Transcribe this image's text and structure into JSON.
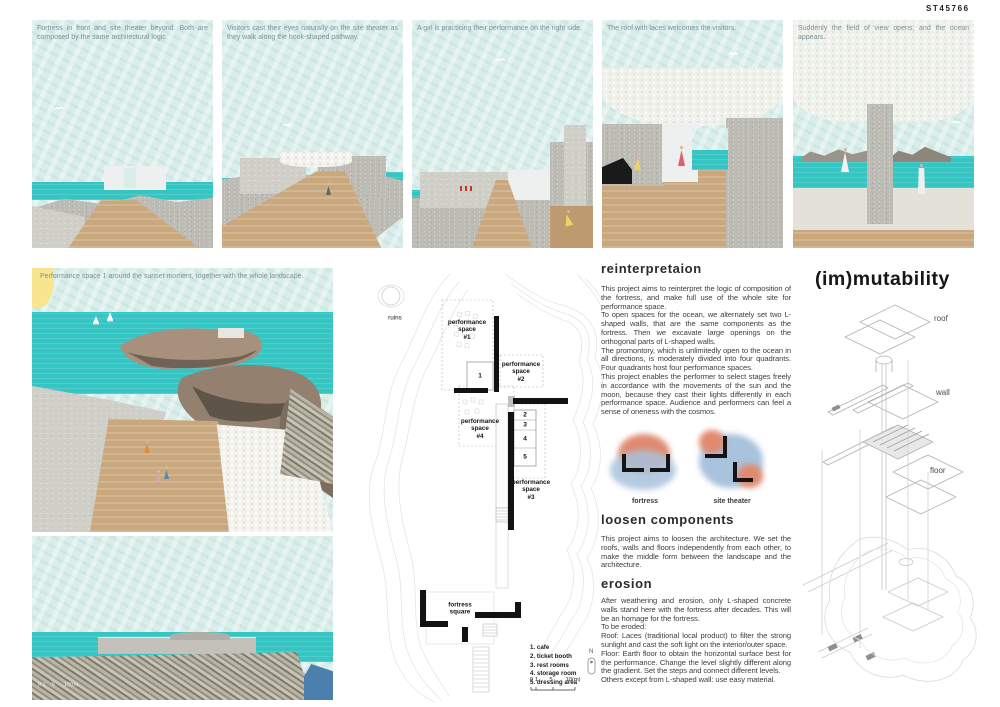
{
  "board": {
    "code": "ST45766",
    "title": "(im)mutability"
  },
  "top_panels": [
    {
      "caption": "Fortress in front and site theater beyond. Both are composed by the same architectural logic."
    },
    {
      "caption": "Visitors cast their eyes naturally on the site theater as they walk along the hook-shaped pathway."
    },
    {
      "caption": "A girl is practicing their performance on the right side."
    },
    {
      "caption": "The roof with laces welcomes the visitors."
    },
    {
      "caption": "Suddenly the field of view opens, and the ocean appears."
    }
  ],
  "hero": {
    "caption": "Performance space 1 around the sunset moment, together with the whole landscape."
  },
  "section_view": {
    "scale_note": "0 1    5      10(m)"
  },
  "site_plan": {
    "ruins": "ruins",
    "spaces": [
      "performance\nspace\n#1",
      "performance\nspace\n#2",
      "performance\nspace\n#3",
      "performance\nspace\n#4"
    ],
    "rooms": [
      "1",
      "2",
      "3",
      "4",
      "5"
    ],
    "fortress_square": "fortress\nsquare",
    "legend": [
      "1.  cafe",
      "2.  ticket booth",
      "3.  rest rooms",
      "4.  storage room",
      "5.  dressing area"
    ],
    "scale": "0 1       5        10(m)",
    "north": "N"
  },
  "concept_diagrams": {
    "fortress": "fortress",
    "site_theater": "site theater"
  },
  "sections": [
    {
      "heading": "reinterpretaion",
      "body": "This project aims to reinterpret the logic of composition of the fortress, and make full use of the whole site for performance space.\nTo open spaces for the ocean, we alternately set two L-shaped walls, that are the same components as the fortress. Then we excavate large openings on the orthogonal parts of L-shaped walls.\nThe promontory, which is unlimitedly open to the ocean in all directions, is moderately divided into four quadrants. Four quadrants host four performance spaces.\nThis project enables the performer to select stages freely in accordance with the movements of the sun and the moon, because they cast their lights differently in each performance space. Audience and performers can feel a sense of oneness with the cosmos."
    },
    {
      "heading": "loosen components",
      "body": "This project aims to loosen the architecture. We set the roofs, walls and floors independently from each other, to make the middle form between the landscape and the architecture."
    },
    {
      "heading": "erosion",
      "body": "After weathering and erosion, only L-shaped concrete walls stand here with the fortress after decades. This will be an homage for the fortress.\nTo be eroded:\nRoof: Laces (traditional local product) to filter the strong sunlight and cast the soft light on the interior/outer space.\nFloor: Earth floor to obtain the horizontal surface best for the performance. Change the level slightly different along the gradient. Set the steps and connect different levels.\nOthers except from L-shaped wall: use easy material."
    }
  ],
  "axon_labels": {
    "roof": "roof",
    "wall": "wall",
    "floor": "floor"
  },
  "colors": {
    "sky": "#d9edea",
    "sea": "#35c5c3",
    "sand": "#c9a87e",
    "stone": "#bcbbb4",
    "watercolor_orange": "#e08a70",
    "watercolor_blue": "#9fbddb",
    "ink": "#1c1c1c",
    "caption": "#7d9296"
  }
}
